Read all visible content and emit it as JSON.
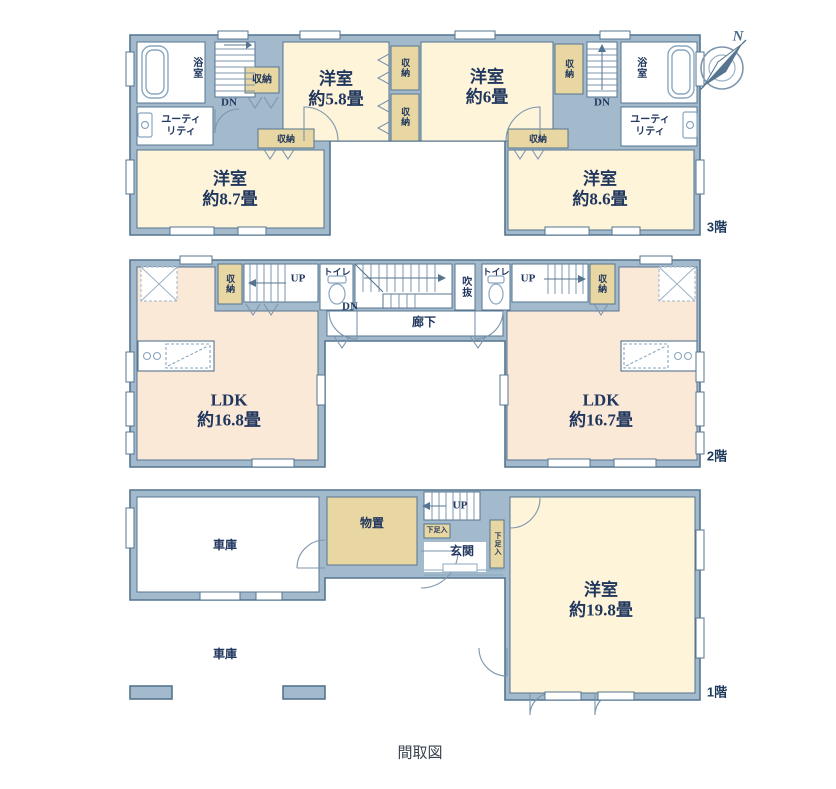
{
  "caption": "間取図",
  "compass": {
    "north": "N"
  },
  "labels": {
    "storage": "収納",
    "toilet": "トイレ",
    "bath": "浴室",
    "utility": "ユーティリティ",
    "dn": "DN",
    "up": "UP",
    "void": "吹抜",
    "hallway": "廊下",
    "garage": "車庫",
    "storeroom": "物置",
    "entrance": "玄関",
    "shoe_box": "下足入"
  },
  "floors": {
    "third": {
      "tag": "3階",
      "rooms": {
        "west58": {
          "name": "洋室",
          "area": "約5.8畳"
        },
        "west6": {
          "name": "洋室",
          "area": "約6畳"
        },
        "west87": {
          "name": "洋室",
          "area": "約8.7畳"
        },
        "west86": {
          "name": "洋室",
          "area": "約8.6畳"
        }
      }
    },
    "second": {
      "tag": "2階",
      "rooms": {
        "ldk_left": {
          "name": "LDK",
          "area": "約16.8畳"
        },
        "ldk_right": {
          "name": "LDK",
          "area": "約16.7畳"
        }
      }
    },
    "first": {
      "tag": "1階",
      "rooms": {
        "west198": {
          "name": "洋室",
          "area": "約19.8畳"
        }
      }
    }
  },
  "colors": {
    "wall": "#a3bacd",
    "wall_stroke": "#54748f",
    "room_cream": "#fdf4da",
    "room_peach": "#fbe9d8",
    "closet_tan": "#e8d7a2",
    "text_navy": "#21375e"
  }
}
